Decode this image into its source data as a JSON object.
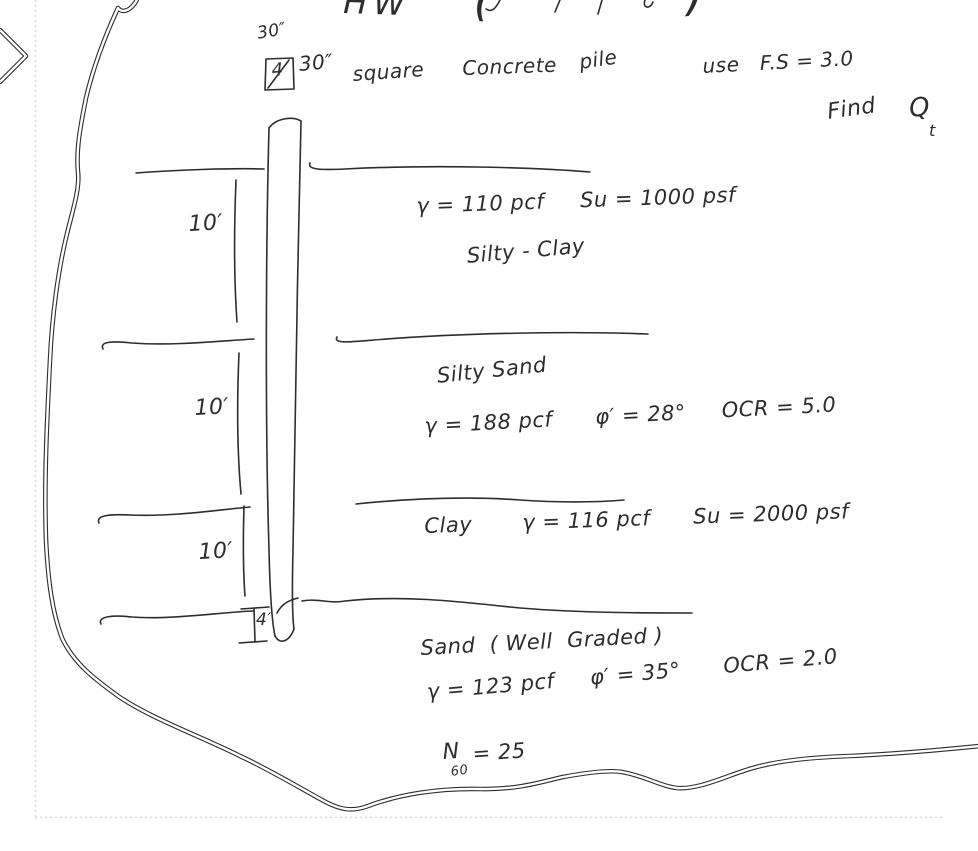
{
  "colors": {
    "ink": "#2d2d2d",
    "paper": "#ffffff",
    "page_guide": "#d6d6d6"
  },
  "header": {
    "title": "HW",
    "paren_open": "(",
    "paren_close": ")",
    "pile_width_label": "30″",
    "pile_count_box": "4",
    "pile_spec": [
      "30″",
      "square",
      "Concrete",
      "pile"
    ],
    "use_note": "use   F.S = 3.0",
    "find_label": "Find",
    "find_symbol": "Q",
    "find_subscript": "t"
  },
  "strata": [
    {
      "depth": "10′",
      "properties": "γ = 110 pcf     Su = 1000 psf",
      "name": "Silty - Clay"
    },
    {
      "depth": "10′",
      "name": "Silty Sand",
      "properties": "γ = 188 pcf      φ′ = 28°     OCR = 5.0"
    },
    {
      "depth": "10′",
      "name_and_properties": "Clay       γ = 116 pcf      Su = 2000 psf"
    },
    {
      "depth": "4′",
      "name": "Sand  ( Well  Graded )",
      "properties": "γ = 123 pcf     φ′ = 35°      OCR = 2.0",
      "spt_symbol": "N",
      "spt_subscript": "60",
      "spt_value": "= 25"
    }
  ]
}
